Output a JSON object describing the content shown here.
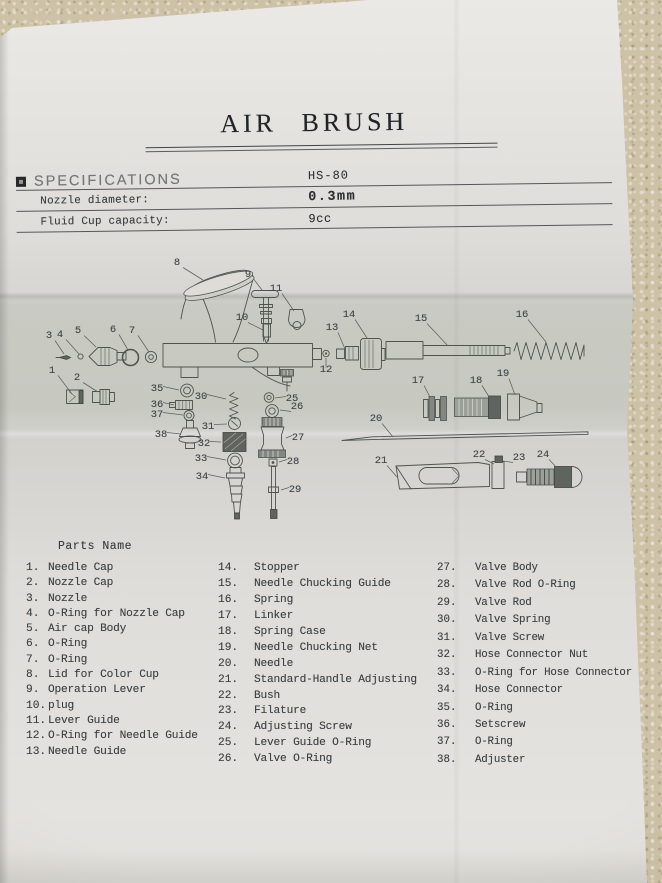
{
  "document": {
    "title": "AIR BRUSH",
    "model": "HS-80",
    "specifications": {
      "heading": "SPECIFICATIONS",
      "rows": [
        {
          "label": "Nozzle diameter:",
          "value": "0.3mm"
        },
        {
          "label": "Fluid Cup capacity:",
          "value": "9cc"
        }
      ]
    },
    "parts_list": {
      "heading": "Parts Name",
      "columns": [
        {
          "items": [
            {
              "num": "1.",
              "name": "Needle Cap"
            },
            {
              "num": "2.",
              "name": "Nozzle Cap"
            },
            {
              "num": "3.",
              "name": "Nozzle"
            },
            {
              "num": "4.",
              "name": "O-Ring for Nozzle Cap"
            },
            {
              "num": "5.",
              "name": "Air cap Body"
            },
            {
              "num": "6.",
              "name": "O-Ring"
            },
            {
              "num": "7.",
              "name": "O-Ring"
            },
            {
              "num": "8.",
              "name": "Lid for Color Cup"
            },
            {
              "num": "9.",
              "name": "Operation Lever"
            },
            {
              "num": "10.",
              "name": "plug"
            },
            {
              "num": "11.",
              "name": "Lever Guide"
            },
            {
              "num": "12.",
              "name": "O-Ring for Needle Guide"
            },
            {
              "num": "13.",
              "name": "Needle Guide"
            }
          ]
        },
        {
          "items": [
            {
              "num": "14.",
              "name": "Stopper"
            },
            {
              "num": "15.",
              "name": "Needle Chucking Guide"
            },
            {
              "num": "16.",
              "name": "Spring"
            },
            {
              "num": "17.",
              "name": "Linker"
            },
            {
              "num": "18.",
              "name": "Spring Case"
            },
            {
              "num": "19.",
              "name": "Needle Chucking Net"
            },
            {
              "num": "20.",
              "name": "Needle"
            },
            {
              "num": "21.",
              "name": "Standard-Handle Adjusting"
            },
            {
              "num": "22.",
              "name": "Bush"
            },
            {
              "num": "23.",
              "name": "Filature"
            },
            {
              "num": "24.",
              "name": "Adjusting Screw"
            },
            {
              "num": "25.",
              "name": "Lever Guide O-Ring"
            },
            {
              "num": "26.",
              "name": "Valve O-Ring"
            }
          ]
        },
        {
          "items": [
            {
              "num": "27.",
              "name": "Valve Body"
            },
            {
              "num": "28.",
              "name": "Valve Rod O-Ring"
            },
            {
              "num": "29.",
              "name": "Valve Rod"
            },
            {
              "num": "30.",
              "name": "Valve Spring"
            },
            {
              "num": "31.",
              "name": "Valve Screw"
            },
            {
              "num": "32.",
              "name": "Hose Connector Nut"
            },
            {
              "num": "33.",
              "name": "O-Ring for Hose Connector"
            },
            {
              "num": "34.",
              "name": "Hose Connector"
            },
            {
              "num": "35.",
              "name": "O-Ring"
            },
            {
              "num": "36.",
              "name": "Setscrew"
            },
            {
              "num": "37.",
              "name": "O-Ring"
            },
            {
              "num": "38.",
              "name": "Adjuster"
            }
          ]
        }
      ]
    },
    "diagram": {
      "callouts": [
        {
          "n": "1",
          "x": 52,
          "y": 373,
          "lx": 72,
          "ly": 394
        },
        {
          "n": "2",
          "x": 77,
          "y": 380,
          "lx": 98,
          "ly": 392
        },
        {
          "n": "3",
          "x": 49,
          "y": 338,
          "lx": 64,
          "ly": 354
        },
        {
          "n": "4",
          "x": 60,
          "y": 337,
          "lx": 79,
          "ly": 354
        },
        {
          "n": "5",
          "x": 78,
          "y": 333,
          "lx": 96,
          "ly": 347
        },
        {
          "n": "6",
          "x": 113,
          "y": 332,
          "lx": 128,
          "ly": 350
        },
        {
          "n": "7",
          "x": 132,
          "y": 333,
          "lx": 149,
          "ly": 352
        },
        {
          "n": "8",
          "x": 177,
          "y": 265,
          "lx": 203,
          "ly": 280
        },
        {
          "n": "9",
          "x": 248,
          "y": 277,
          "lx": 262,
          "ly": 290
        },
        {
          "n": "10",
          "x": 242,
          "y": 320,
          "lx": 263,
          "ly": 330
        },
        {
          "n": "11",
          "x": 276,
          "y": 291,
          "lx": 294,
          "ly": 311
        },
        {
          "n": "12",
          "x": 326,
          "y": 372,
          "lx": 326,
          "ly": 358
        },
        {
          "n": "13",
          "x": 332,
          "y": 330,
          "lx": 345,
          "ly": 349
        },
        {
          "n": "14",
          "x": 349,
          "y": 317,
          "lx": 367,
          "ly": 338
        },
        {
          "n": "15",
          "x": 421,
          "y": 321,
          "lx": 448,
          "ly": 346
        },
        {
          "n": "16",
          "x": 522,
          "y": 317,
          "lx": 546,
          "ly": 342
        },
        {
          "n": "17",
          "x": 418,
          "y": 383,
          "lx": 430,
          "ly": 397
        },
        {
          "n": "18",
          "x": 476,
          "y": 383,
          "lx": 491,
          "ly": 400
        },
        {
          "n": "19",
          "x": 503,
          "y": 376,
          "lx": 515,
          "ly": 395
        },
        {
          "n": "20",
          "x": 376,
          "y": 421,
          "lx": 393,
          "ly": 437
        },
        {
          "n": "21",
          "x": 381,
          "y": 463,
          "lx": 397,
          "ly": 477
        },
        {
          "n": "22",
          "x": 479,
          "y": 457,
          "lx": 494,
          "ly": 464
        },
        {
          "n": "23",
          "x": 519,
          "y": 460,
          "lx": 503,
          "ly": 461
        },
        {
          "n": "24",
          "x": 543,
          "y": 457,
          "lx": 562,
          "ly": 473
        },
        {
          "n": "25",
          "x": 292,
          "y": 401,
          "lx": 275,
          "ly": 398
        },
        {
          "n": "26",
          "x": 297,
          "y": 409,
          "lx": 280,
          "ly": 410
        },
        {
          "n": "27",
          "x": 298,
          "y": 440,
          "lx": 286,
          "ly": 438
        },
        {
          "n": "28",
          "x": 293,
          "y": 464,
          "lx": 279,
          "ly": 462
        },
        {
          "n": "29",
          "x": 295,
          "y": 492,
          "lx": 281,
          "ly": 490
        },
        {
          "n": "30",
          "x": 201,
          "y": 399,
          "lx": 226,
          "ly": 399
        },
        {
          "n": "31",
          "x": 208,
          "y": 429,
          "lx": 227,
          "ly": 424
        },
        {
          "n": "32",
          "x": 204,
          "y": 446,
          "lx": 221,
          "ly": 442
        },
        {
          "n": "33",
          "x": 201,
          "y": 461,
          "lx": 226,
          "ly": 460
        },
        {
          "n": "34",
          "x": 202,
          "y": 479,
          "lx": 225,
          "ly": 478
        },
        {
          "n": "35",
          "x": 157,
          "y": 391,
          "lx": 179,
          "ly": 390
        },
        {
          "n": "36",
          "x": 157,
          "y": 407,
          "lx": 174,
          "ly": 405
        },
        {
          "n": "37",
          "x": 157,
          "y": 417,
          "lx": 183,
          "ly": 415
        },
        {
          "n": "38",
          "x": 161,
          "y": 437,
          "lx": 181,
          "ly": 434
        }
      ]
    }
  }
}
